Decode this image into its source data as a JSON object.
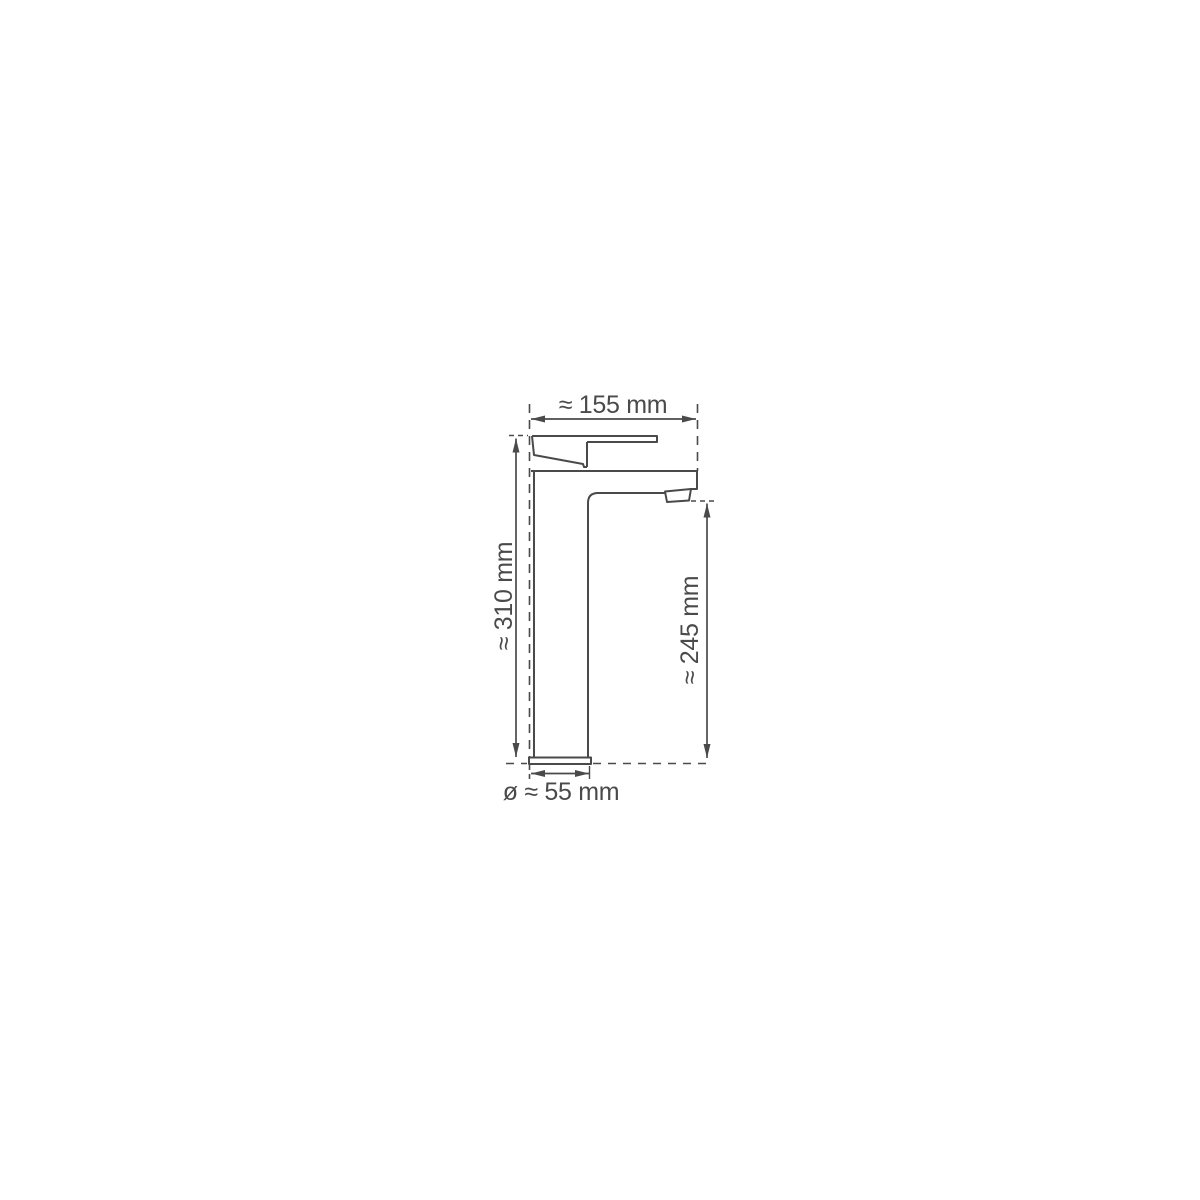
{
  "diagram": {
    "labels": {
      "overall_width": "≈ 155 mm",
      "overall_height": "≈ 310 mm",
      "spout_height": "≈ 245 mm",
      "base_diameter": "ø ≈ 55 mm"
    }
  },
  "colors": {
    "line": "#4a4a4a",
    "background": "#ffffff"
  }
}
